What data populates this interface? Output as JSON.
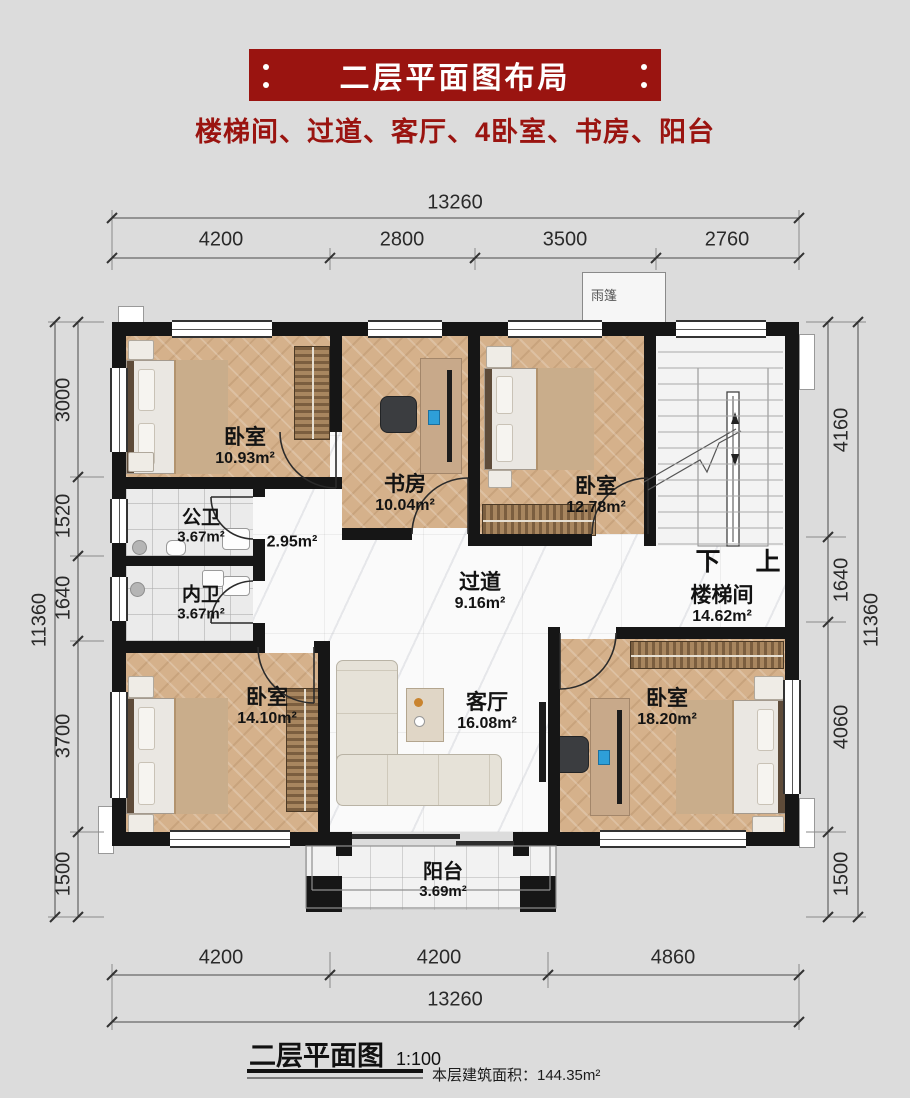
{
  "colors": {
    "banner-red": "#9a1410",
    "wall-black": "#161616",
    "wood-floor": "#d5b18b",
    "marble-floor": "#fafafa",
    "page-bg": "#dcdcdc"
  },
  "header": {
    "title": "二层平面图布局",
    "subtitle": "楼梯间、过道、客厅、4卧室、书房、阳台"
  },
  "plan": {
    "rooms": [
      {
        "id": "bedroom-top-left",
        "name": "卧室",
        "area": "10.93m²"
      },
      {
        "id": "study",
        "name": "书房",
        "area": "10.04m²"
      },
      {
        "id": "bedroom-top-right",
        "name": "卧室",
        "area": "12.78m²"
      },
      {
        "id": "public-bath",
        "name": "公卫",
        "area": "3.67m²"
      },
      {
        "id": "inner-bath",
        "name": "内卫",
        "area": "3.67m²"
      },
      {
        "id": "hallway",
        "name": "过道",
        "area": "9.16m²"
      },
      {
        "id": "stairwell",
        "name": "楼梯间",
        "area": "14.62m²"
      },
      {
        "id": "bedroom-bottom-left",
        "name": "卧室",
        "area": "14.10m²"
      },
      {
        "id": "living-room",
        "name": "客厅",
        "area": "16.08m²"
      },
      {
        "id": "bedroom-bottom-right",
        "name": "卧室",
        "area": "18.20m²"
      },
      {
        "id": "balcony",
        "name": "阳台",
        "area": "3.69m²"
      }
    ],
    "annotations": {
      "small_corridor_area": "2.95m²",
      "canopy": "雨篷",
      "stair_down": "下",
      "stair_up": "上"
    }
  },
  "dimensions": {
    "top": {
      "total": "13260",
      "segments": [
        "4200",
        "2800",
        "3500",
        "2760"
      ]
    },
    "bottom": {
      "total": "13260",
      "segments": [
        "4200",
        "4200",
        "4860"
      ]
    },
    "left": {
      "total": "11360",
      "segments": [
        "3000",
        "1520",
        "1640",
        "3700",
        "1500"
      ]
    },
    "right": {
      "total": "11360",
      "segments": [
        "4160",
        "1640",
        "4060",
        "1500"
      ]
    }
  },
  "legend": {
    "title": "二层平面图",
    "scale": "1:100",
    "area_note": "本层建筑面积：144.35m²"
  }
}
